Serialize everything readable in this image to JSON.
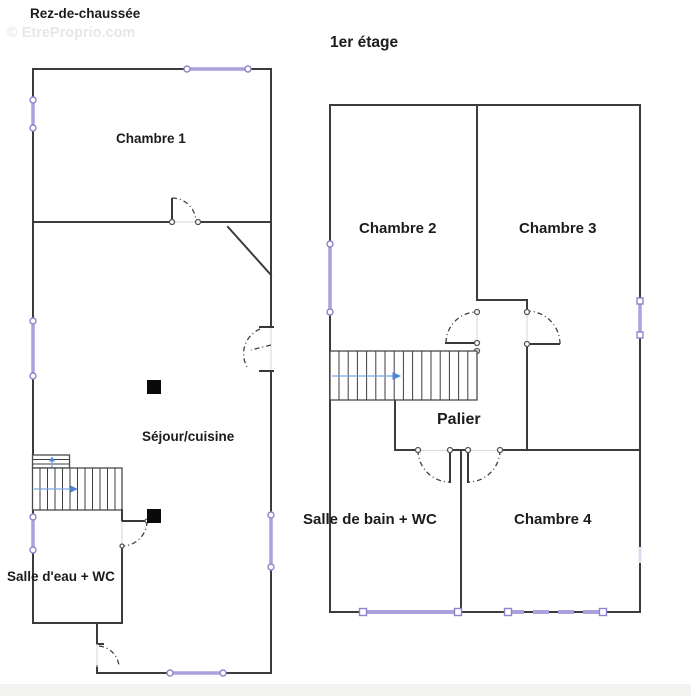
{
  "watermark": "© EtreProprio.com",
  "ground_floor": {
    "title": "Rez-de-chaussée",
    "rooms": {
      "chambre1": "Chambre 1",
      "sejour": "Séjour/cuisine",
      "salle_eau": "Salle d'eau + WC"
    }
  },
  "first_floor": {
    "title": "1er étage",
    "rooms": {
      "chambre2": "Chambre 2",
      "chambre3": "Chambre 3",
      "palier": "Palier",
      "salle_bain": "Salle de bain + WC",
      "chambre4": "Chambre 4"
    }
  },
  "colors": {
    "wall": "#3c3c3c",
    "window": "#a9a2dc",
    "stair_arrow": "#4f86d6",
    "watermark": "#e7e7e4"
  }
}
